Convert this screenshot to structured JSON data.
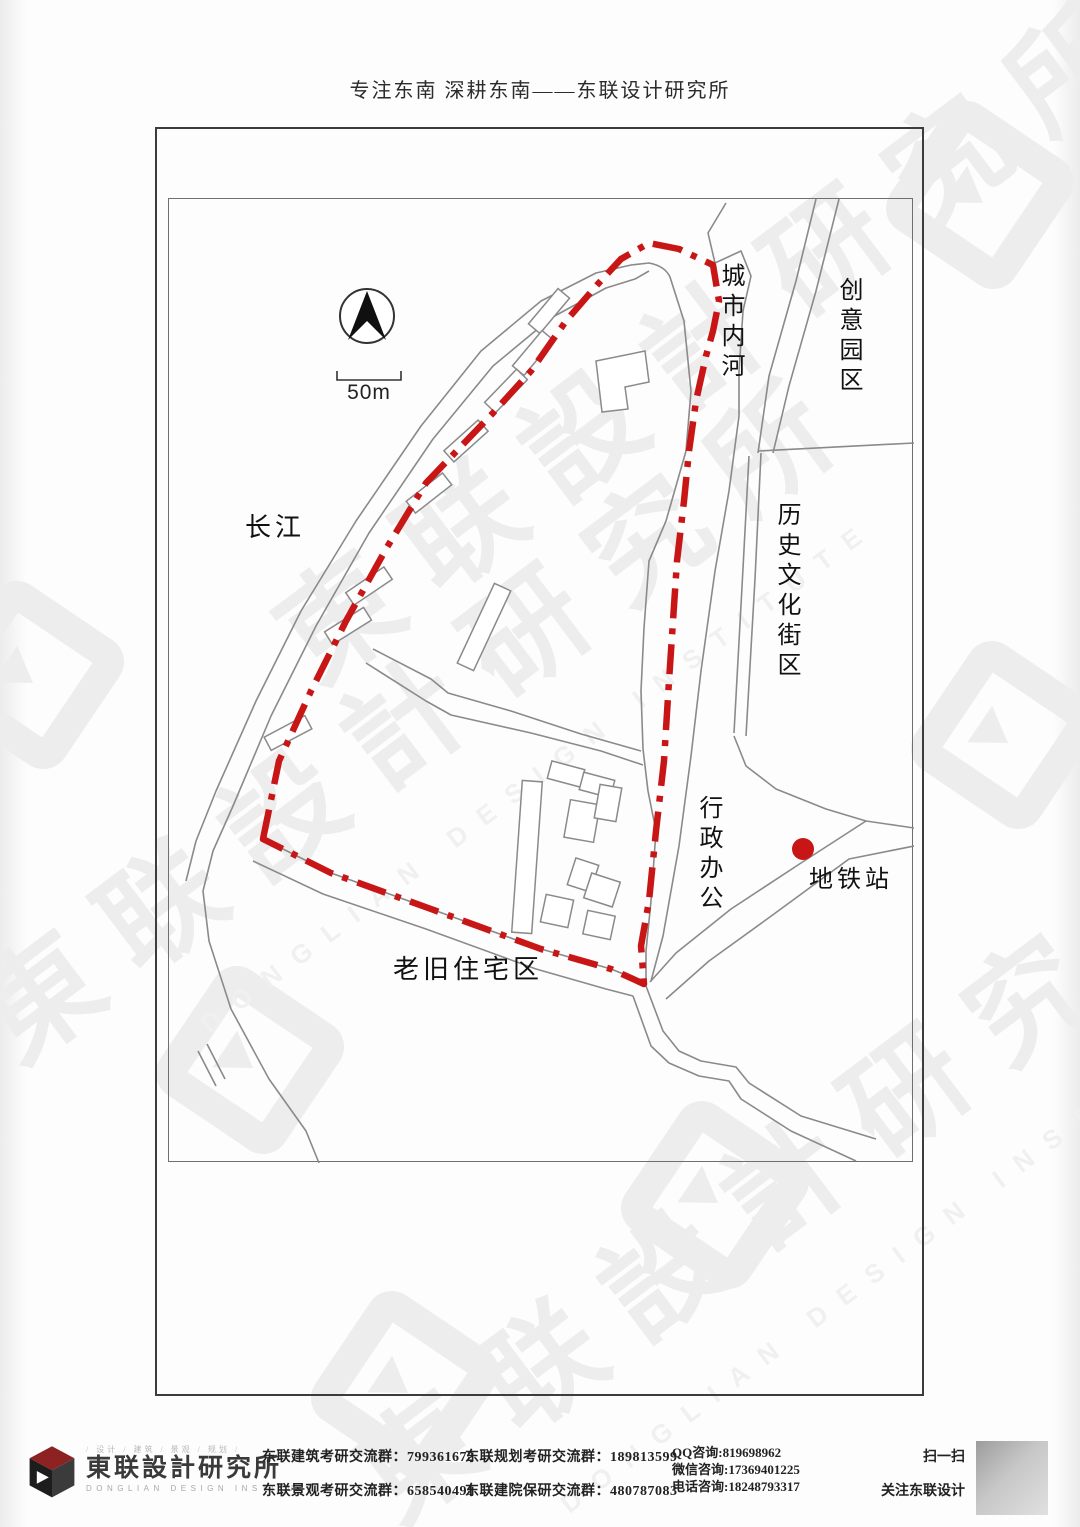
{
  "header": {
    "title": "专注东南 深耕东南——东联设计研究所"
  },
  "map": {
    "scale_label": "50m",
    "labels": {
      "yangtze": "长江",
      "city_river": "城市内河",
      "creative_park": "创意园区",
      "historic_district": "历史文化街区",
      "admin_office": "行政办公",
      "metro_station": "地铁站",
      "old_residential": "老旧住宅区"
    },
    "icons": {
      "north_arrow": "north-compass",
      "metro_marker": "red-dot"
    },
    "colors": {
      "site_boundary": "#c81616",
      "metro_dot": "#c81616",
      "road": "#8a8a8a"
    }
  },
  "footer": {
    "logo": {
      "tagline": "/ 设计 / 建筑 / 景观 / 规划 /",
      "cn": "東联設計研究所",
      "en": "DONGLIAN DESIGN INSTITUTE"
    },
    "groups": [
      {
        "label": "东联建筑考研交流群：",
        "value": "799361672"
      },
      {
        "label": "东联规划考研交流群：",
        "value": "189813599"
      },
      {
        "label": "东联景观考研交流群：",
        "value": "658540491"
      },
      {
        "label": "东联建院保研交流群：",
        "value": "480787083"
      }
    ],
    "contacts": [
      {
        "label": "QQ咨询:",
        "value": "819698962"
      },
      {
        "label": "微信咨询:",
        "value": "17369401225"
      },
      {
        "label": "电话咨询:",
        "value": "18248793317"
      }
    ],
    "qr": {
      "line1": "扫一扫",
      "line2": "关注东联设计"
    }
  },
  "watermark": {
    "cn": "東联設計研究所",
    "en": "DONGLIAN DESIGN INSTITUTE"
  }
}
